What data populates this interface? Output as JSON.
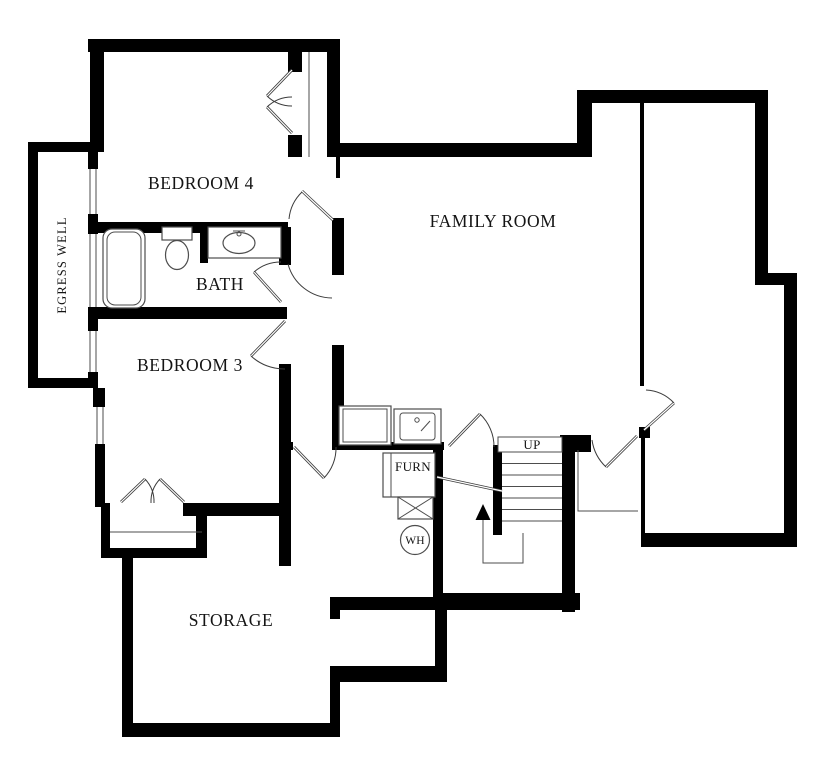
{
  "plan": {
    "rooms": {
      "bedroom4": "BEDROOM 4",
      "bath": "BATH",
      "bedroom3": "BEDROOM 3",
      "family_room": "FAMILY ROOM",
      "storage": "STORAGE",
      "egress_well": "EGRESS WELL"
    },
    "annotations": {
      "stairs_up": "UP",
      "furnace": "FURN",
      "water_heater": "WH"
    },
    "colors": {
      "wall": "#000000",
      "background": "#ffffff",
      "fixture_line": "#4d4d4d",
      "door_line": "#3c3c3c",
      "text": "#141414"
    }
  }
}
